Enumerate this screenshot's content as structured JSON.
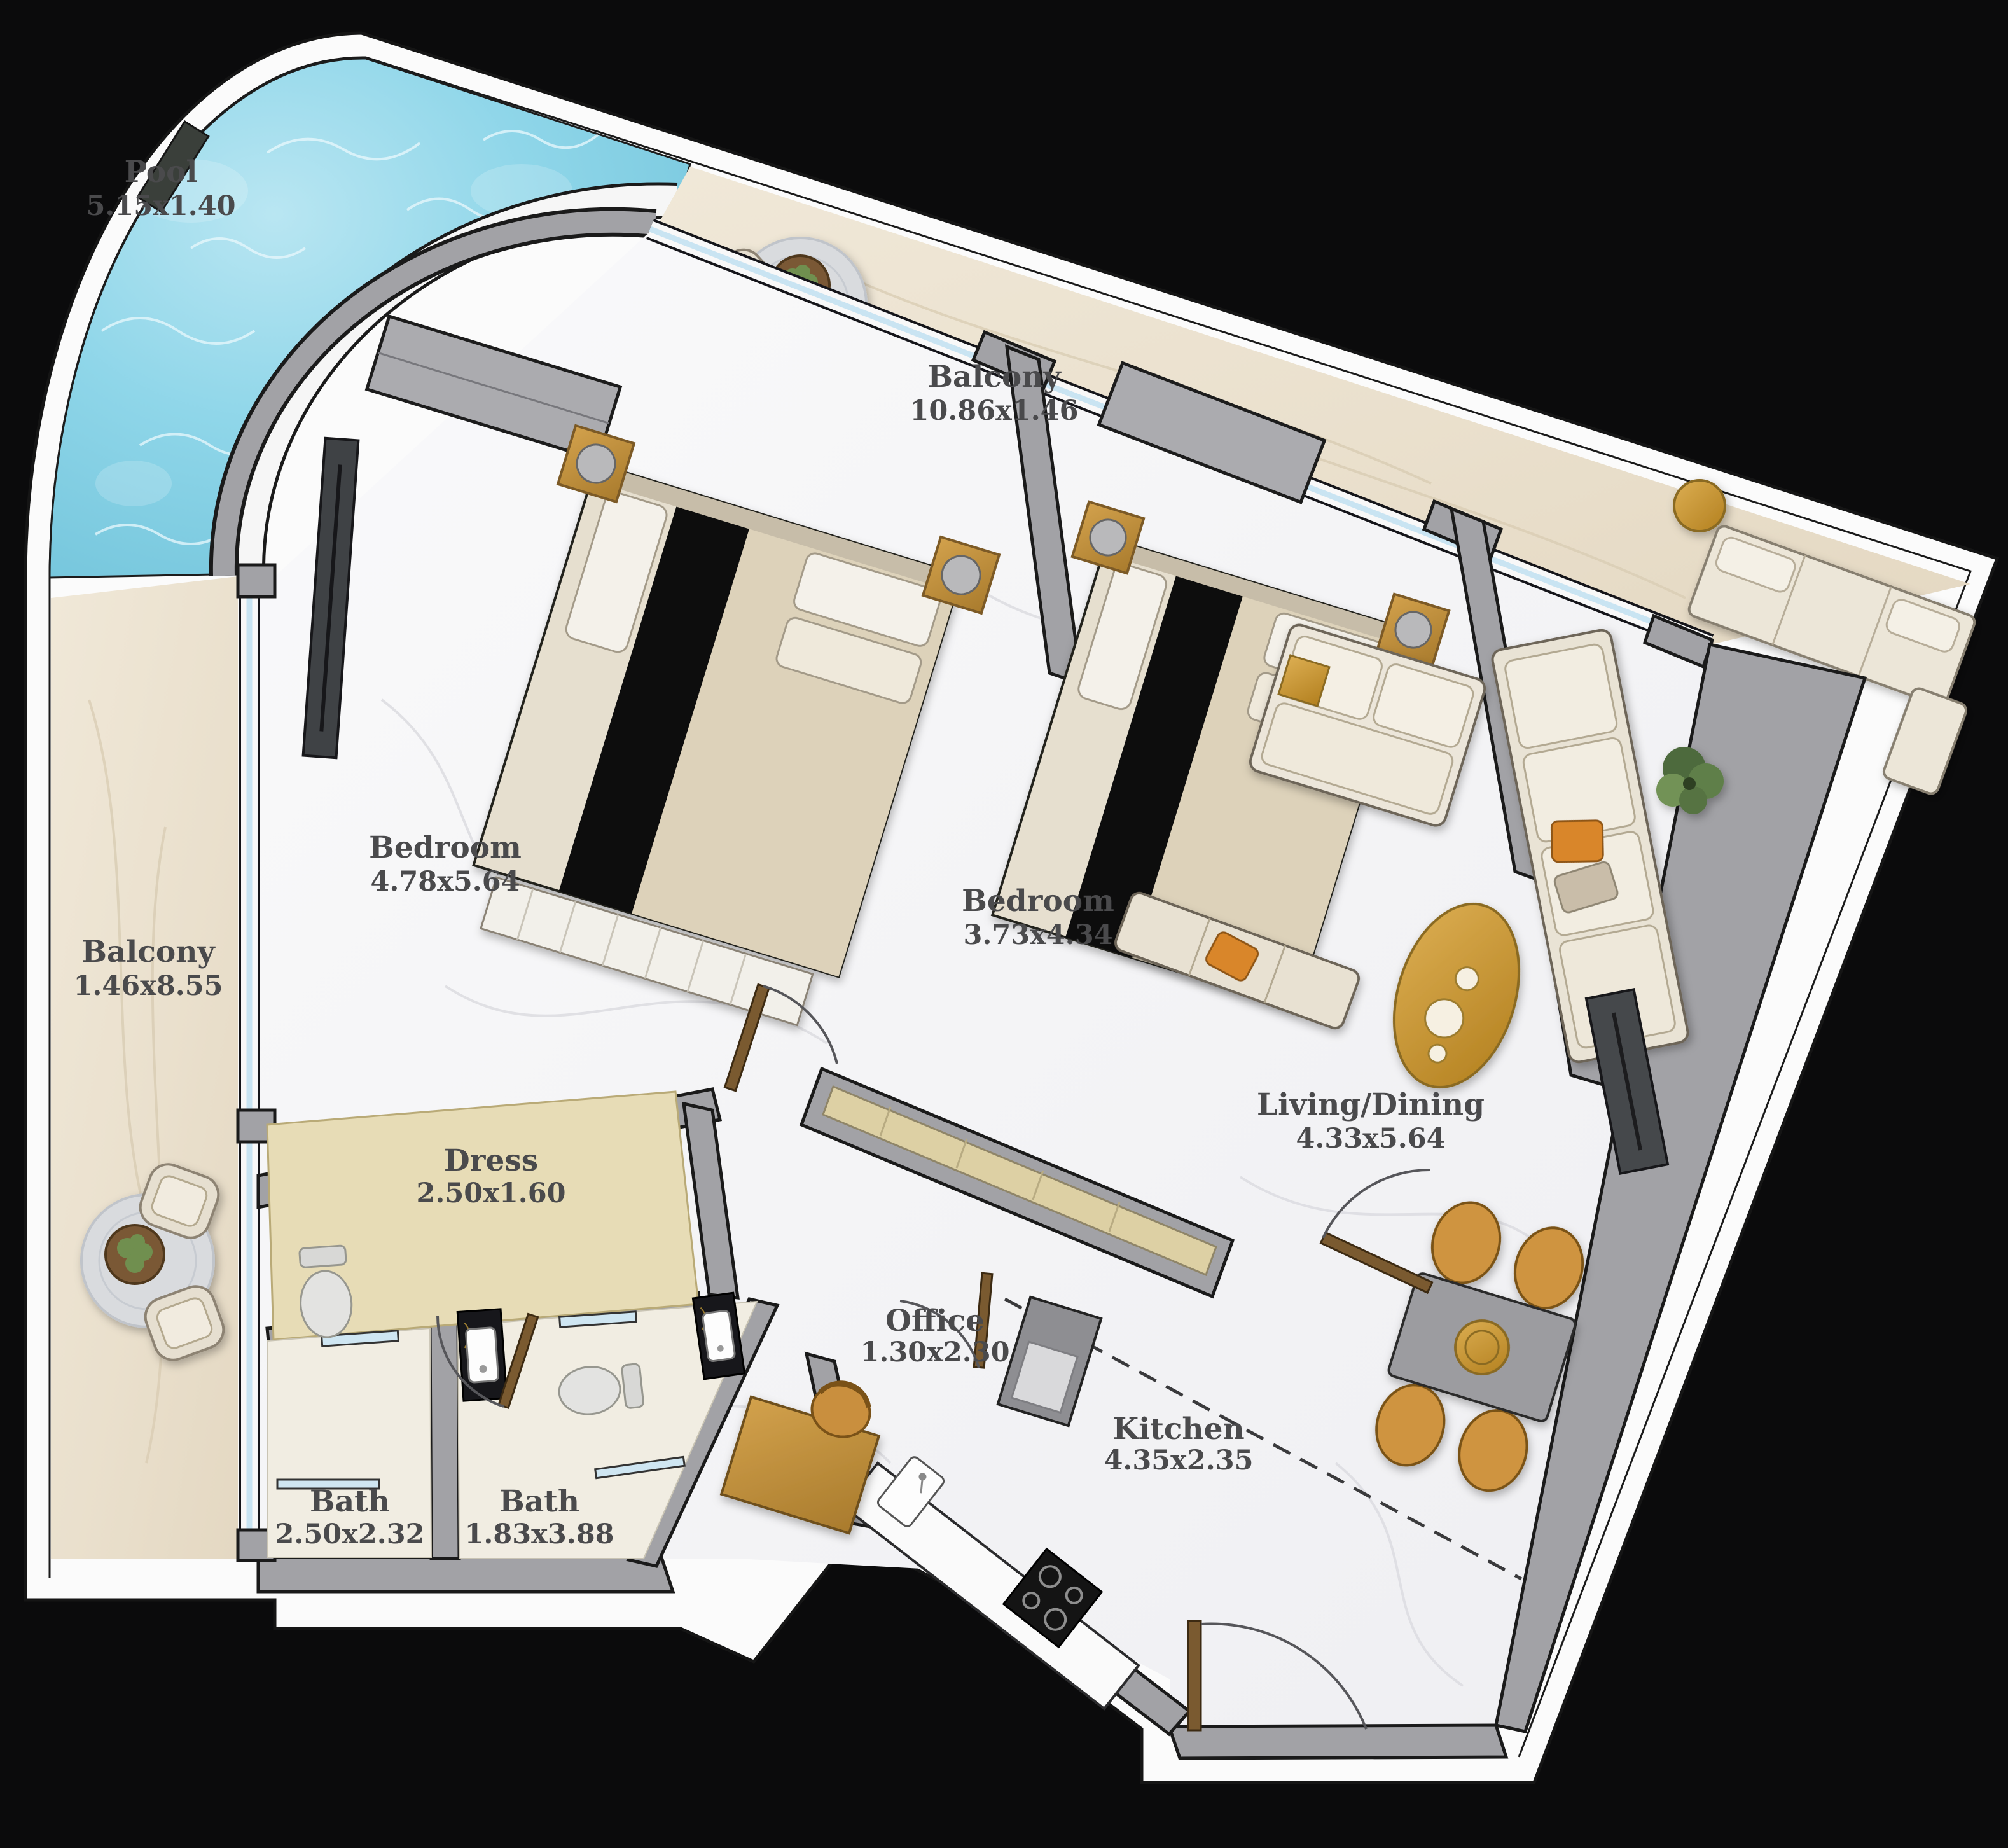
{
  "plan": {
    "type": "apartment-floor-plan",
    "background": "#0b0b0c",
    "colors": {
      "slab": "#fbfbfb",
      "pool_water": "#85cfe4",
      "balcony_floor": "#ebe2d1",
      "interior_floor": "#f7f7f8",
      "wall": "#a2a2a6",
      "glass": "#c9e4f2",
      "wood": "#c4933f",
      "dark_marble": "#17171b",
      "label_text": "#4a4a4c"
    },
    "rooms": [
      {
        "key": "pool",
        "name": "Pool",
        "dims": "5.15x1.40"
      },
      {
        "key": "balcony-top",
        "name": "Balcony",
        "dims": "10.86x1.46"
      },
      {
        "key": "balcony-left",
        "name": "Balcony",
        "dims": "1.46x8.55"
      },
      {
        "key": "bedroom-1",
        "name": "Bedroom",
        "dims": "4.78x5.64"
      },
      {
        "key": "bedroom-2",
        "name": "Bedroom",
        "dims": "3.73x4.34"
      },
      {
        "key": "living-dining",
        "name": "Living/Dining",
        "dims": "4.33x5.64"
      },
      {
        "key": "dress",
        "name": "Dress",
        "dims": "2.50x1.60"
      },
      {
        "key": "office",
        "name": "Office",
        "dims": "1.30x2.30"
      },
      {
        "key": "kitchen",
        "name": "Kitchen",
        "dims": "4.35x2.35"
      },
      {
        "key": "bath-1",
        "name": "Bath",
        "dims": "2.50x2.32"
      },
      {
        "key": "bath-2",
        "name": "Bath",
        "dims": "1.83x3.88"
      }
    ]
  }
}
